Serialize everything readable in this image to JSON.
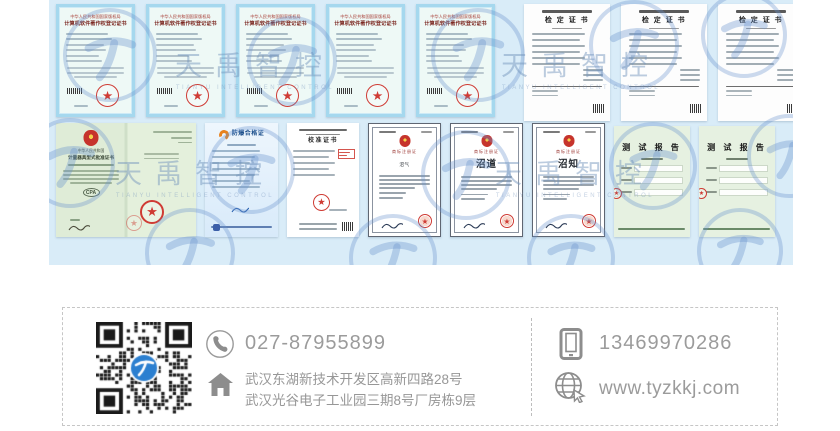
{
  "watermark": {
    "text": "天禹智控",
    "subtext": "TIANYU INTELLIGENT CONTROL"
  },
  "certificates": {
    "row1": [
      {
        "type": "copyright",
        "issuer": "中华人民共和国国家版权局",
        "title": "计算机软件著作权登记证书"
      },
      {
        "type": "copyright",
        "issuer": "中华人民共和国国家版权局",
        "title": "计算机软件著作权登记证书"
      },
      {
        "type": "copyright",
        "issuer": "中华人民共和国国家版权局",
        "title": "计算机软件著作权登记证书"
      },
      {
        "type": "copyright",
        "issuer": "中华人民共和国国家版权局",
        "title": "计算机软件著作权登记证书"
      },
      {
        "type": "copyright",
        "issuer": "中华人民共和国国家版权局",
        "title": "计算机软件著作权登记证书"
      },
      {
        "type": "verify",
        "title": "检 定 证 书"
      },
      {
        "type": "verify",
        "title": "检 定 证 书"
      },
      {
        "type": "verify",
        "title": "检 定 证 书"
      }
    ],
    "row2": [
      {
        "type": "approval",
        "issuer": "中华人民共和国",
        "title": "计量器具型式批准证书",
        "badge": "CPA"
      },
      {
        "type": "exproof",
        "title": "防爆合格证"
      },
      {
        "type": "calibration",
        "title": "校准证书"
      },
      {
        "type": "trademark",
        "title": "商标注册证",
        "mark": "沼气"
      },
      {
        "type": "trademark",
        "title": "商标注册证",
        "mark": "沼道"
      },
      {
        "type": "trademark",
        "title": "商标注册证",
        "mark": "沼知"
      },
      {
        "type": "report",
        "title": "测 试 报 告"
      },
      {
        "type": "report",
        "title": "测 试 报 告"
      }
    ]
  },
  "contact": {
    "phone": "027-87955899",
    "mobile": "13469970286",
    "address_line1": "武汉东湖新技术开发区高新四路28号",
    "address_line2": "武汉光谷电子工业园三期8号厂房栋9层",
    "website": "www.tyzkkj.com"
  },
  "colors": {
    "banner_bg": "#d9ecf8",
    "seal_red": "#cf3b34",
    "accent_blue": "#2b7fd0",
    "text_gray": "#9b9b9b"
  }
}
